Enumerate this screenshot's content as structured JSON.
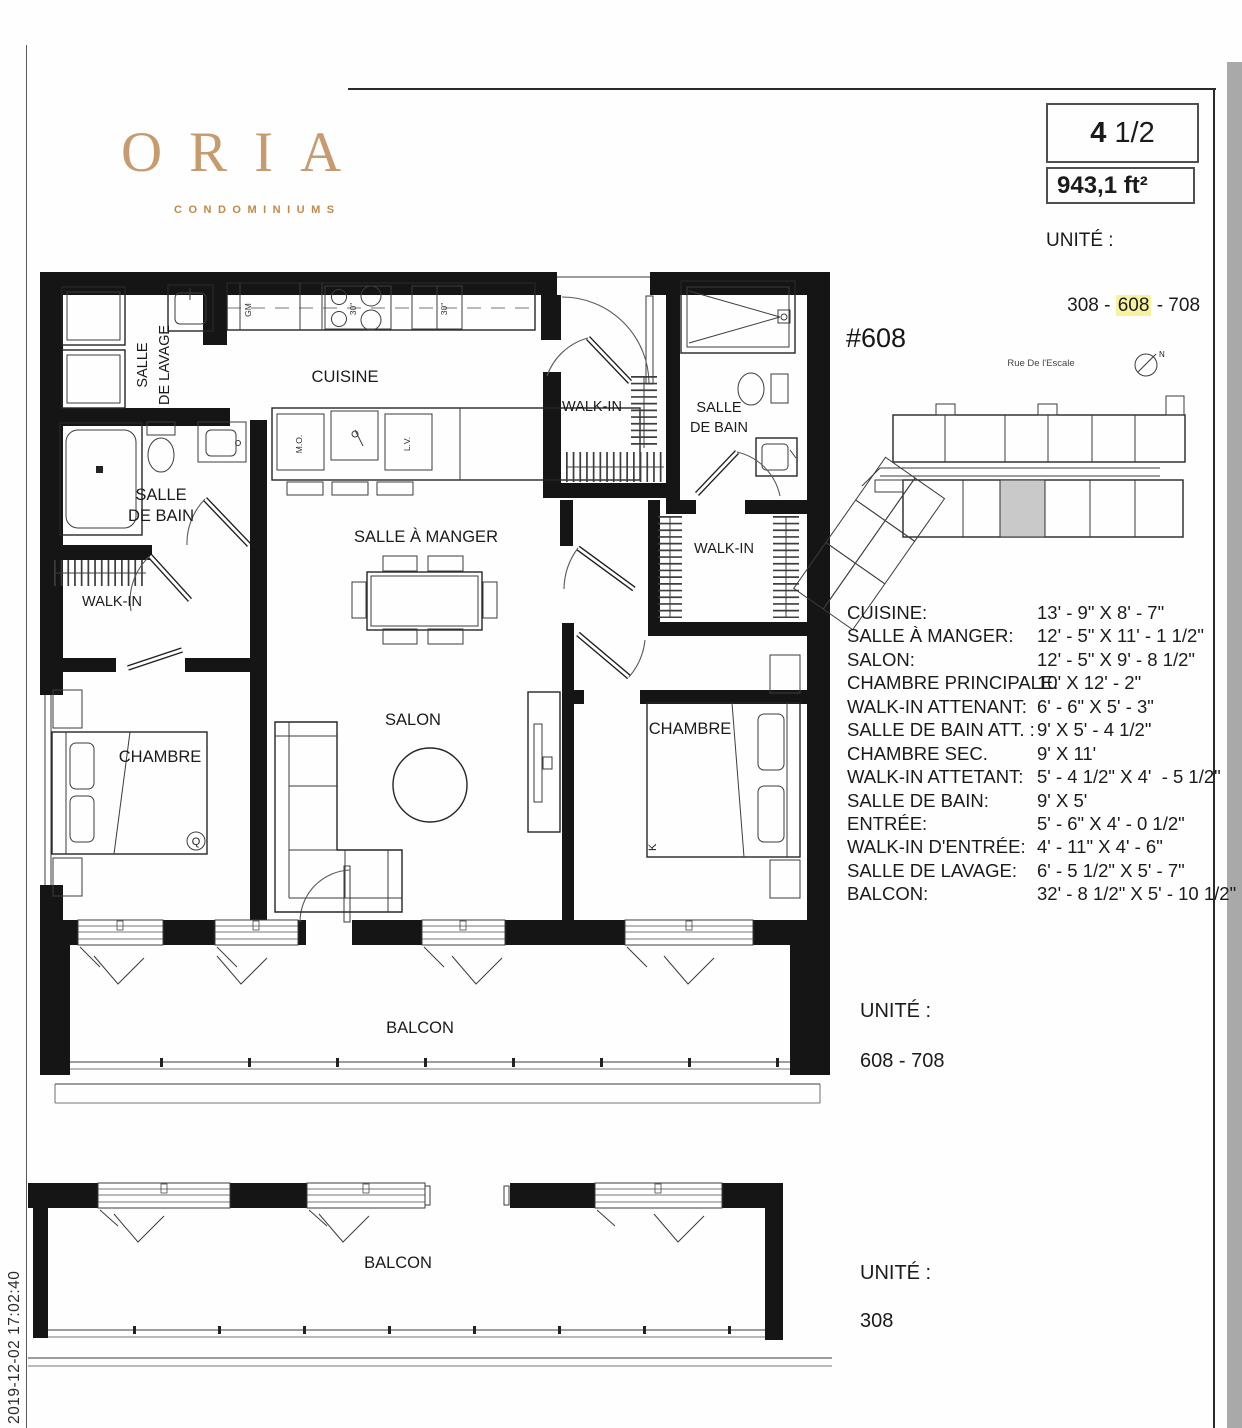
{
  "logo": {
    "name": "ORIA",
    "tagline": "CONDOMINIUMS"
  },
  "header": {
    "unit_type_bold": "4",
    "unit_type_rest": " 1/2",
    "area": "943,1 ft²",
    "unite_label": "UNITÉ :",
    "units_prefix": "308 - ",
    "units_highlight": "608",
    "units_suffix": " - 708",
    "units_full": "308 - 608 - 708"
  },
  "key_plan": {
    "unit_number": "#608",
    "street": "Rue De l'Escale",
    "north": "N",
    "highlight_color": "#c9c9c9"
  },
  "dimensions": {
    "rows": [
      {
        "label": "CUISINE:",
        "value": "13' - 9\" X 8' - 7\""
      },
      {
        "label": "SALLE À MANGER:",
        "value": "12' - 5\" X 11' - 1 1/2\""
      },
      {
        "label": "SALON:",
        "value": "12' - 5\" X 9' - 8 1/2\""
      },
      {
        "label": "CHAMBRE PRINCIPALE:",
        "value": "10' X 12' - 2\""
      },
      {
        "label": "WALK-IN ATTENANT:",
        "value": "6' - 6\" X 5' - 3\""
      },
      {
        "label": "SALLE DE BAIN ATT. :",
        "value": "9' X 5' - 4 1/2\""
      },
      {
        "label": "CHAMBRE SEC.",
        "value": "9' X 11'"
      },
      {
        "label": "WALK-IN ATTETANT:",
        "value": "5' - 4 1/2\" X 4'  - 5 1/2\""
      },
      {
        "label": "SALLE DE BAIN:",
        "value": "9' X 5'"
      },
      {
        "label": "ENTRÉE:",
        "value": "5' - 6\" X 4' - 0 1/2\""
      },
      {
        "label": "WALK-IN D'ENTRÉE:",
        "value": "4' - 11\" X 4' - 6\""
      },
      {
        "label": "SALLE DE LAVAGE:",
        "value": "6' - 5 1/2\" X 5' - 7\""
      },
      {
        "label": "BALCON:",
        "value": "32' - 8 1/2\" X 5' - 10 1/2\""
      }
    ]
  },
  "plan": {
    "rooms": {
      "lavage_l1": "SALLE",
      "lavage_l2": "DE LAVAGE",
      "cuisine": "CUISINE",
      "walkin_entry": "WALK-IN",
      "bain2_l1": "SALLE",
      "bain2_l2": "DE BAIN",
      "bain1_l1": "SALLE",
      "bain1_l2": "DE BAIN",
      "walkin_left": "WALK-IN",
      "walkin_master": "WALK-IN",
      "salle_a_manger": "SALLE À MANGER",
      "salon": "SALON",
      "chambre_left": "CHAMBRE",
      "chambre_right": "CHAMBRE",
      "balcon1": "BALCON",
      "balcon2": "BALCON"
    },
    "marks": {
      "gm": "GM",
      "mo": "M.O.",
      "lv": "L.V.",
      "stove_size": "30\"",
      "fridge_size": "30\"",
      "bed_queen": "Q",
      "bed_king": "K"
    }
  },
  "unite_mid": {
    "label": "UNITÉ :",
    "value": "608 - 708"
  },
  "unite_bottom": {
    "label": "UNITÉ :",
    "value": "308"
  },
  "timestamp": "2019-12-02 17:02:40",
  "colors": {
    "logo_gold": "#c69b6f",
    "tagline_gold": "#bf8a49",
    "highlight_yellow": "#f7f2a0",
    "wall_black": "#151515"
  }
}
